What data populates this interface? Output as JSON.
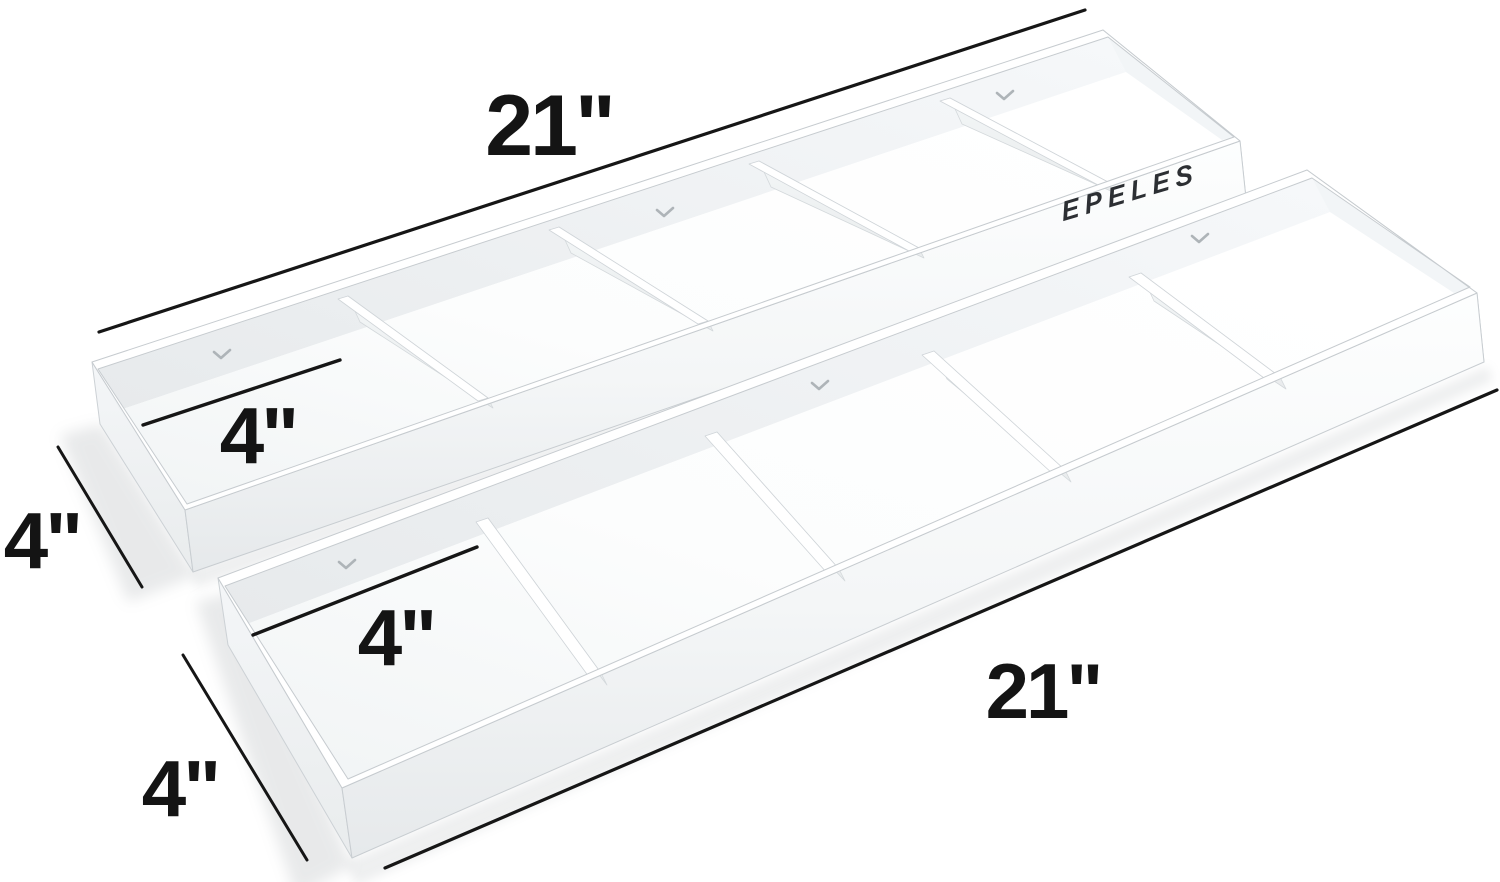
{
  "image": {
    "kind": "product-dimension-photo",
    "background_color": "#ffffff",
    "line_color": "#161616",
    "label_color": "#141414"
  },
  "brand": {
    "name": "EPELES",
    "text_color": "#2c2f33"
  },
  "product": {
    "tray_count": 2,
    "compartments_per_tray": 5,
    "screw_holes_per_tray": 3,
    "body_color": "#ffffff",
    "shade_color": "#e9ecee",
    "edge_color": "#cdd2d6"
  },
  "annotations": {
    "top_tray_length": "21\"",
    "top_tray_compartment": "4\"",
    "top_tray_depth": "4\"",
    "bottom_tray_compartment": "4\"",
    "bottom_tray_depth": "4\"",
    "bottom_tray_length": "21\""
  }
}
